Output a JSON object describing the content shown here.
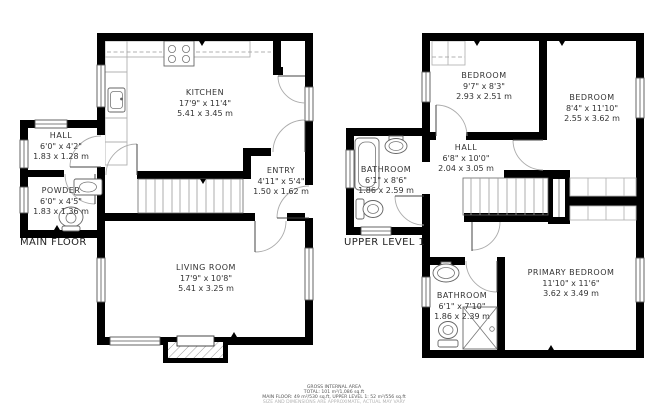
{
  "page": {
    "background_color": "#ffffff",
    "wall_color": "#000000",
    "text_color": "#333333"
  },
  "floors": {
    "main": {
      "title": "MAIN FLOOR",
      "rooms": {
        "kitchen": {
          "name": "KITCHEN",
          "imperial": "17'9\" x 11'4\"",
          "metric": "5.41 x 3.45 m"
        },
        "hall": {
          "name": "HALL",
          "imperial": "6'0\" x 4'2\"",
          "metric": "1.83 x 1.28 m"
        },
        "powder": {
          "name": "POWDER",
          "imperial": "6'0\" x 4'5\"",
          "metric": "1.83 x 1.36 m"
        },
        "entry": {
          "name": "ENTRY",
          "imperial": "4'11\" x 5'4\"",
          "metric": "1.50 x 1.62 m"
        },
        "living_room": {
          "name": "LIVING ROOM",
          "imperial": "17'9\" x 10'8\"",
          "metric": "5.41 x 3.25 m"
        }
      }
    },
    "upper": {
      "title": "UPPER LEVEL 1",
      "rooms": {
        "bedroom_left": {
          "name": "BEDROOM",
          "imperial": "9'7\" x 8'3\"",
          "metric": "2.93 x 2.51 m"
        },
        "bedroom_right": {
          "name": "BEDROOM",
          "imperial": "8'4\" x 11'10\"",
          "metric": "2.55 x 3.62 m"
        },
        "bathroom_top": {
          "name": "BATHROOM",
          "imperial": "6'1\" x 8'6\"",
          "metric": "1.86 x 2.59 m"
        },
        "hall": {
          "name": "HALL",
          "imperial": "6'8\" x 10'0\"",
          "metric": "2.04 x 3.05 m"
        },
        "bathroom_bottom": {
          "name": "BATHROOM",
          "imperial": "6'1\" x 7'10\"",
          "metric": "1.86 x 2.39 m"
        },
        "primary_bedroom": {
          "name": "PRIMARY BEDROOM",
          "imperial": "11'10\" x 11'6\"",
          "metric": "3.62 x 3.49 m"
        }
      }
    }
  },
  "footer": {
    "line1": "GROSS INTERNAL AREA",
    "line2": "TOTAL: 101 m²/1,086 sq.ft",
    "line3": "MAIN FLOOR: 49 m²/530 sq.ft, UPPER LEVEL 1: 52 m²/556 sq.ft",
    "line4": "SIZE AND DIMENSIONS ARE APPROXIMATE, ACTUAL MAY VARY"
  }
}
